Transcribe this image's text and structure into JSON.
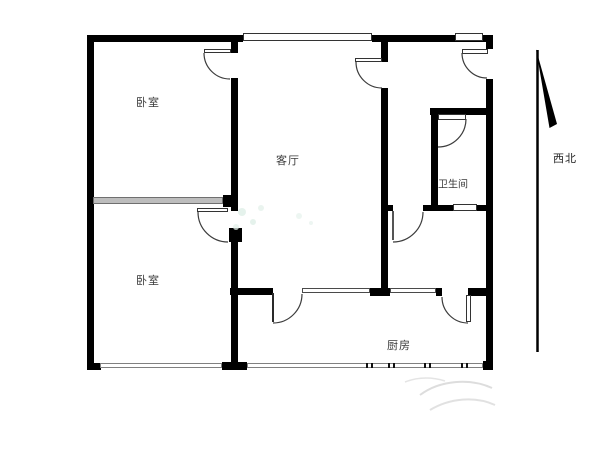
{
  "diagram": {
    "type": "apartment-floor-plan",
    "rooms": [
      {
        "name": "bedroom-top-left",
        "label": "卧室"
      },
      {
        "name": "bedroom-bottom-left",
        "label": "卧室"
      },
      {
        "name": "living-room",
        "label": "客厅"
      },
      {
        "name": "bathroom",
        "label": "卫生间"
      },
      {
        "name": "kitchen",
        "label": "厨房"
      }
    ],
    "compass": {
      "label": "西北",
      "meaning": "northwest",
      "icon": "north-arrow-icon"
    },
    "colors": {
      "wall": "#000000",
      "window_line": "#808080",
      "partition": "#bdbdbd",
      "label_text": "#3a3a3a",
      "background": "#ffffff"
    }
  }
}
